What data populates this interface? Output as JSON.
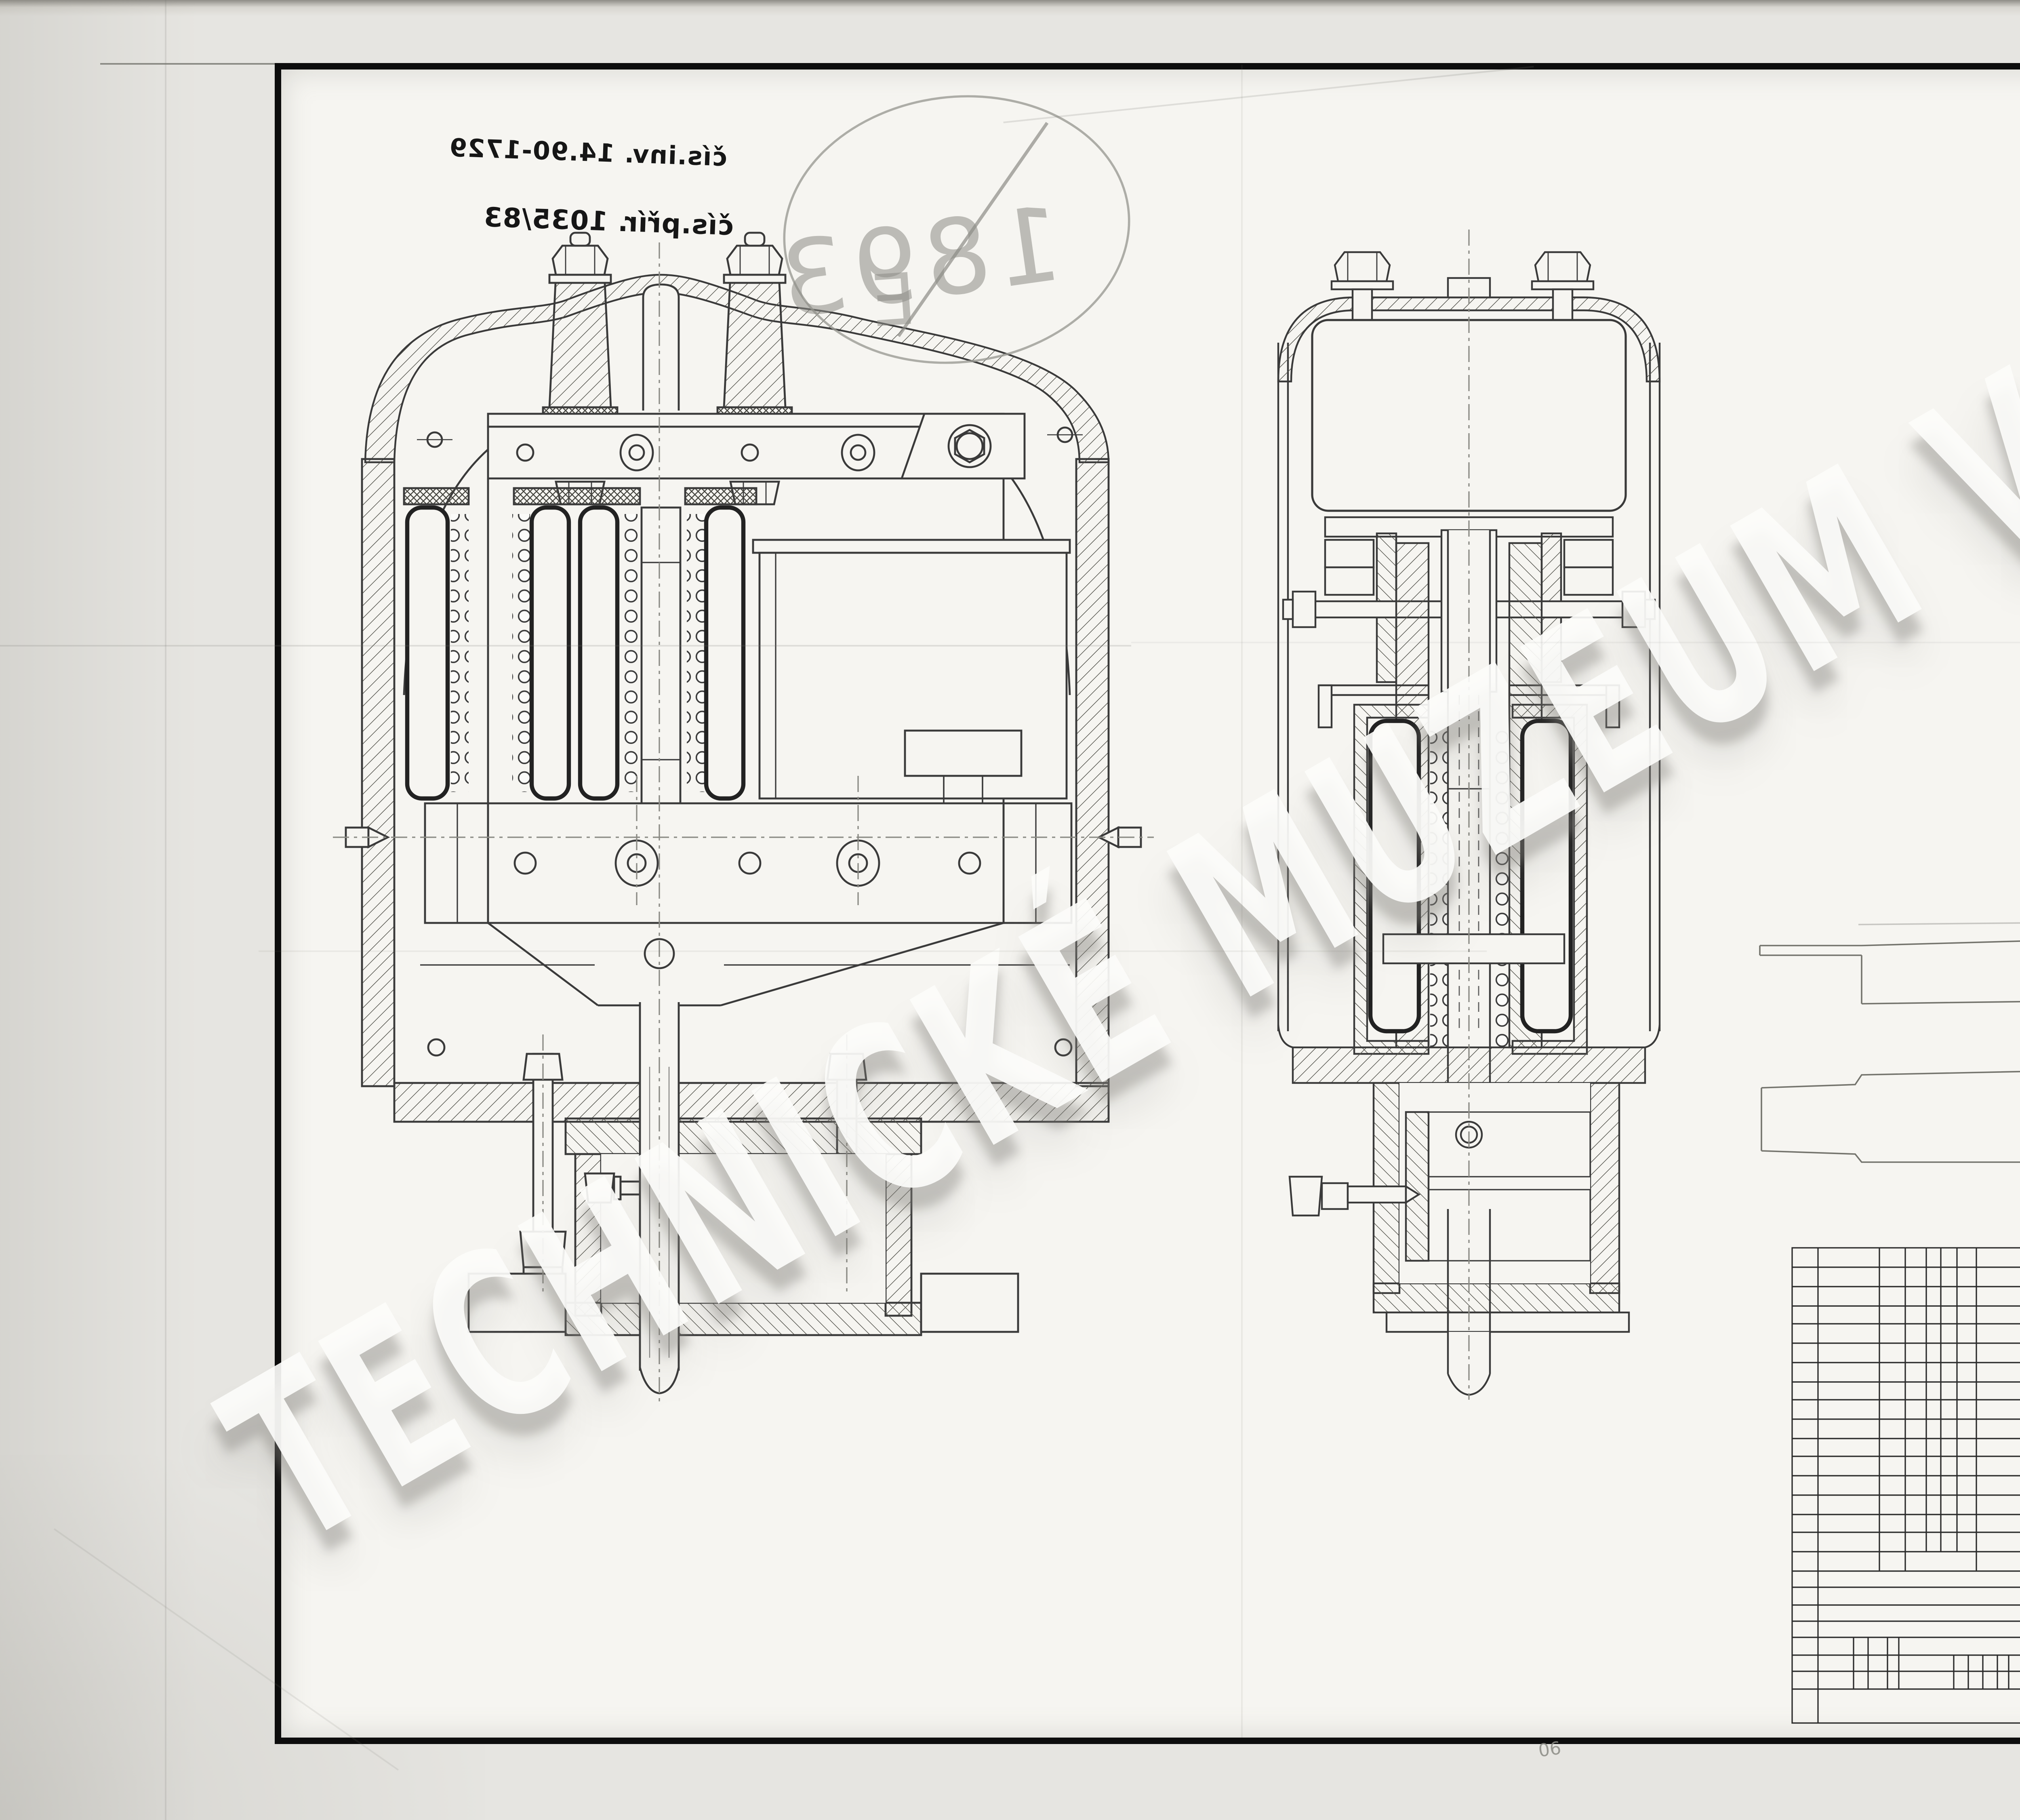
{
  "annotations": {
    "inventory_number_note": "čís.inv. 14.90-1729",
    "accession_number_note": "čís.přír. 1035/83",
    "corner_pencil_note": "06"
  },
  "stamp": {
    "number": "1893",
    "suffix": "E",
    "full_text": "1893/E"
  },
  "watermark": {
    "text": "TECHNICKÉ MUZEUM V BRNĚ"
  },
  "colors": {
    "paper": "#e6e5e1",
    "sheet": "#f6f5f1",
    "frame": "#0d0d0d",
    "ink": "#3a3a3a",
    "pencil": "#8d8d87",
    "watermark_fill": "#fcfcfa",
    "watermark_shadow": "#82807a"
  }
}
